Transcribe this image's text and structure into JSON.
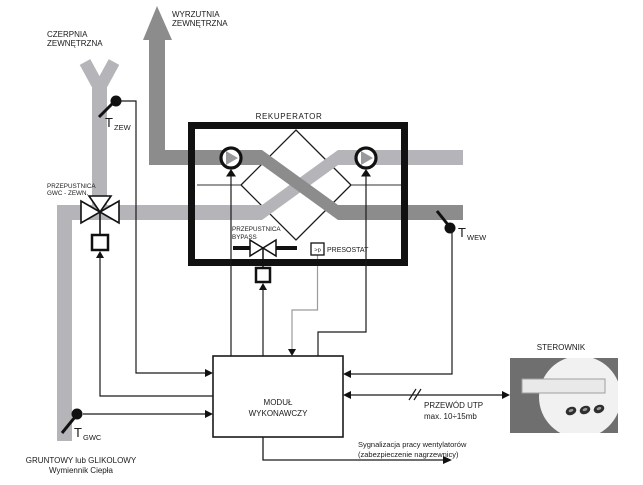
{
  "colors": {
    "duct_light": "#b4b4b9",
    "duct_dark": "#8c8c8c",
    "line": "#1a1a1a",
    "controller_body": "#6f6f6f",
    "controller_face": "#f1f1f1",
    "controller_display": "#e9e9e9"
  },
  "intake": {
    "label_line1": "CZERPNIA",
    "label_line2": "ZEWNĘTRZNA"
  },
  "exhaust": {
    "label_line1": "WYRZUTNIA",
    "label_line2": "ZEWNĘTRZNA"
  },
  "recuperator": {
    "label": "REKUPERATOR",
    "bypass_damper": {
      "label_line1": "PRZEPUSTNICA",
      "label_line2": "BYPASS"
    },
    "pressure_switch": {
      "symbol": ">p",
      "label": "PRESOSTAT"
    }
  },
  "gwc_damper": {
    "label_line1": "PRZEPUSTNICA",
    "label_line2": "GWC - ZEWN."
  },
  "sensors": {
    "t_zew": {
      "symbol": "T",
      "subscript": "ZEW"
    },
    "t_wew": {
      "symbol": "T",
      "subscript": "WEW"
    },
    "t_gwc": {
      "symbol": "T",
      "subscript": "GWC"
    }
  },
  "module": {
    "label_line1": "MODUŁ",
    "label_line2": "WYKONAWCZY"
  },
  "controller": {
    "label": "STEROWNIK"
  },
  "utp": {
    "label_line1": "PRZEWÓD UTP",
    "label_line2": "max. 10÷15mb"
  },
  "signal": {
    "label_line1": "Sygnalizacja pracy wentylatorów",
    "label_line2": "(zabezpieczenie nagrzewnicy)"
  },
  "ground_exchanger": {
    "label_line1": "GRUNTOWY lub GLIKOLOWY",
    "label_line2": "Wymiennik Ciepła"
  }
}
